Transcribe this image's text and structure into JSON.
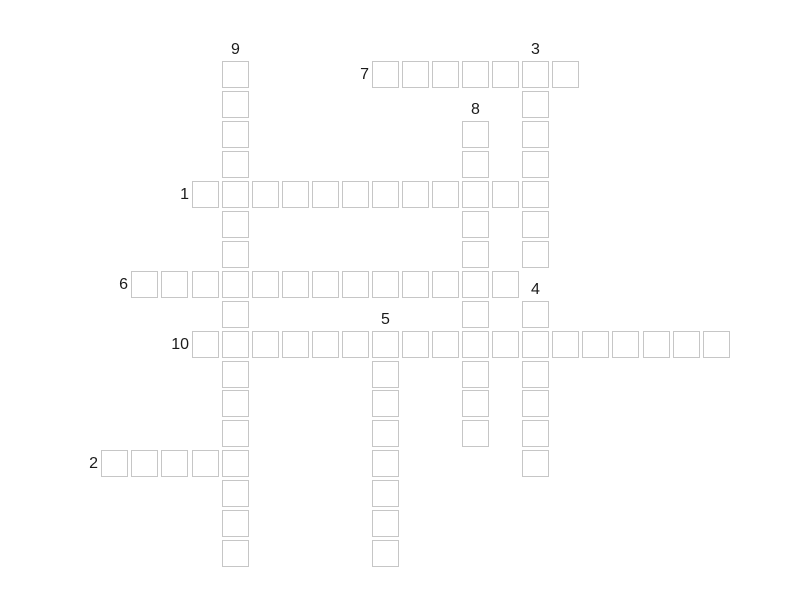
{
  "page": {
    "background_color": "#ffffff",
    "description": "empty crossword puzzle grid"
  },
  "board": {
    "origin_x": 101.3,
    "origin_y": 61,
    "pitch_x": 30.07,
    "pitch_y": 29.95,
    "cell_size": 27,
    "cell_fill_color": "#ffffff",
    "cell_border_color": "#c6c6c6",
    "label_color": "#1b1b1b"
  },
  "entries": [
    {
      "number": "1",
      "direction": "across",
      "col": 3,
      "row": 4,
      "length": 12
    },
    {
      "number": "2",
      "direction": "across",
      "col": 0,
      "row": 13,
      "length": 5
    },
    {
      "number": "3",
      "direction": "down",
      "col": 14,
      "row": 0,
      "length": 7
    },
    {
      "number": "4",
      "direction": "down",
      "col": 14,
      "row": 8,
      "length": 6
    },
    {
      "number": "5",
      "direction": "down",
      "col": 9,
      "row": 9,
      "length": 8
    },
    {
      "number": "6",
      "direction": "across",
      "col": 1,
      "row": 7,
      "length": 13
    },
    {
      "number": "7",
      "direction": "across",
      "col": 9,
      "row": 0,
      "length": 7
    },
    {
      "number": "8",
      "direction": "down",
      "col": 12,
      "row": 2,
      "length": 11
    },
    {
      "number": "9",
      "direction": "down",
      "col": 4,
      "row": 0,
      "length": 17
    },
    {
      "number": "10",
      "direction": "across",
      "col": 3,
      "row": 9,
      "length": 18
    }
  ]
}
